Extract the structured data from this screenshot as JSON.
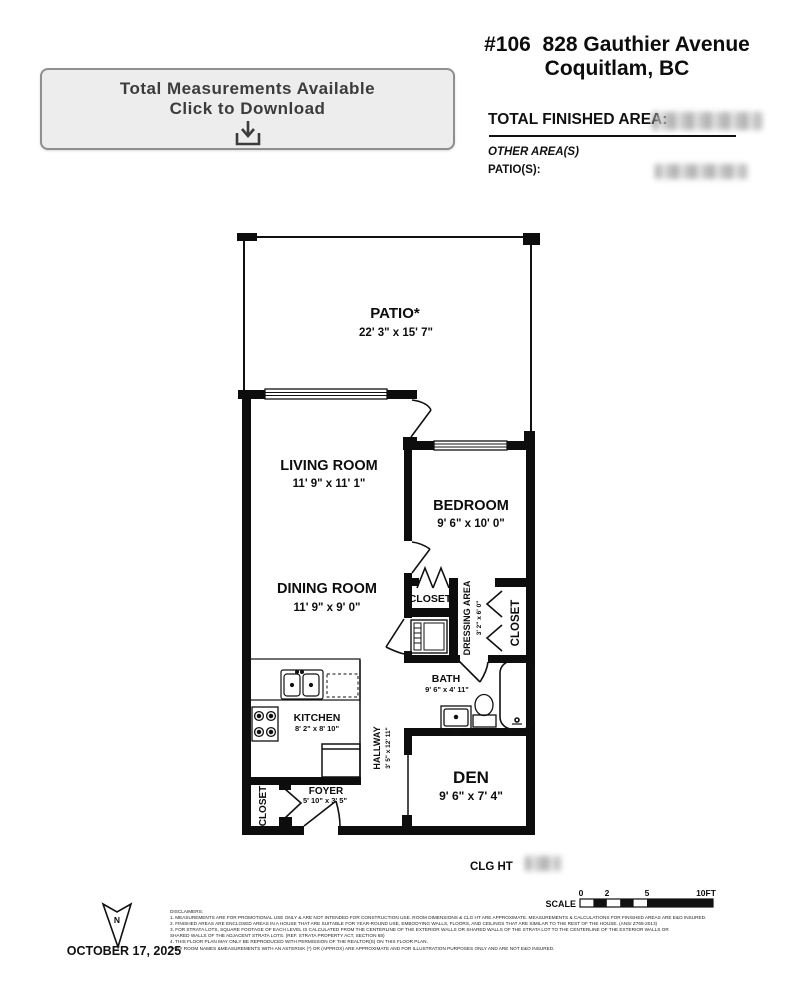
{
  "header": {
    "address_line1": "#106  828 Gauthier Avenue",
    "address_line2": "Coquitlam, BC",
    "total_finished_area_label": "TOTAL FINISHED AREA:",
    "other_areas_label": "OTHER AREA(S)",
    "patios_label": "PATIO(S):"
  },
  "download_button": {
    "line1": "Total Measurements Available",
    "line2": "Click to Download"
  },
  "floor_plan": {
    "rooms": {
      "patio": {
        "name": "PATIO*",
        "dims": "22' 3\" x 15' 7\""
      },
      "living_room": {
        "name": "LIVING ROOM",
        "dims": "11' 9\" x 11' 1\""
      },
      "bedroom": {
        "name": "BEDROOM",
        "dims": "9' 6\" x 10' 0\""
      },
      "dining_room": {
        "name": "DINING ROOM",
        "dims": "11' 9\" x 9' 0\""
      },
      "bedroom_closet": {
        "name": "CLOSET"
      },
      "dressing_area": {
        "name": "DRESSING AREA",
        "dims": "3' 2\" x 6' 0\""
      },
      "dressing_closet": {
        "name": "CLOSET"
      },
      "bath": {
        "name": "BATH",
        "dims": "9' 6\" x 4' 11\""
      },
      "kitchen": {
        "name": "KITCHEN",
        "dims": "8' 2\" x 8' 10\""
      },
      "hallway": {
        "name": "HALLWAY",
        "dims": "3' 5\" x 12' 11\""
      },
      "foyer": {
        "name": "FOYER",
        "dims": "5' 10\" x 3' 5\""
      },
      "entry_closet": {
        "name": "CLOSET"
      },
      "den": {
        "name": "DEN",
        "dims": "9' 6\" x 7' 4\""
      }
    },
    "ceiling_height_label": "CLG HT",
    "scale": {
      "label": "SCALE",
      "ticks": [
        "0",
        "2",
        "5",
        "10FT"
      ]
    },
    "north_indicator": "N"
  },
  "footer": {
    "date": "OCTOBER 17, 2025",
    "disclaimers": [
      "DISCLAIMERS:",
      "1. MEASUREMENTS ARE FOR PROMOTIONAL USE ONLY & ARE NOT INTENDED FOR CONSTRUCTION USE. ROOM DIMENSIONS & CLG HT ARE APPROXIMATE. MEASUREMENTS & CALCULATIONS FOR FINISHED AREAS ARE E&O INSURED.",
      "2. FINISHED AREAS ARE ENCLOSED AREAS IN A HOUSE THAT ARE SUITABLE FOR YEAR-ROUND USE, EMBODYING WALLS, FLOORS, AND CEILINGS THAT ARE SIMILAR TO THE REST OF THE HOUSE. (ANSI Z765-2013)",
      "3. FOR STRATA LOTS, SQUARE FOOTAGE OF EACH LEVEL IS CALCULATED FROM THE CENTERLINE OF THE EXTERIOR WALLS OR SHARED WALLS OF THE STRATA LOT TO THE CENTERLINE OF THE EXTERIOR WALLS OR",
      "SHARED WALLS OF THE ADJACENT STRATA LOTS. (REF. STRATA PROPERTY ACT, SECTION 68)",
      "4. THIS FLOOR PLAN MAY ONLY BE REPRODUCED WITH PERMISSION OF THE REALTOR(S) ON THIS FLOOR PLAN.",
      "* ANY ROOM NAMES &MEASUREMENTS WITH AN ASTERISK (*) OR (APPROX) ARE APPROXIMATE AND FOR ILLUSTRATION PURPOSES ONLY AND ARE NOT E&O INSURED."
    ]
  }
}
